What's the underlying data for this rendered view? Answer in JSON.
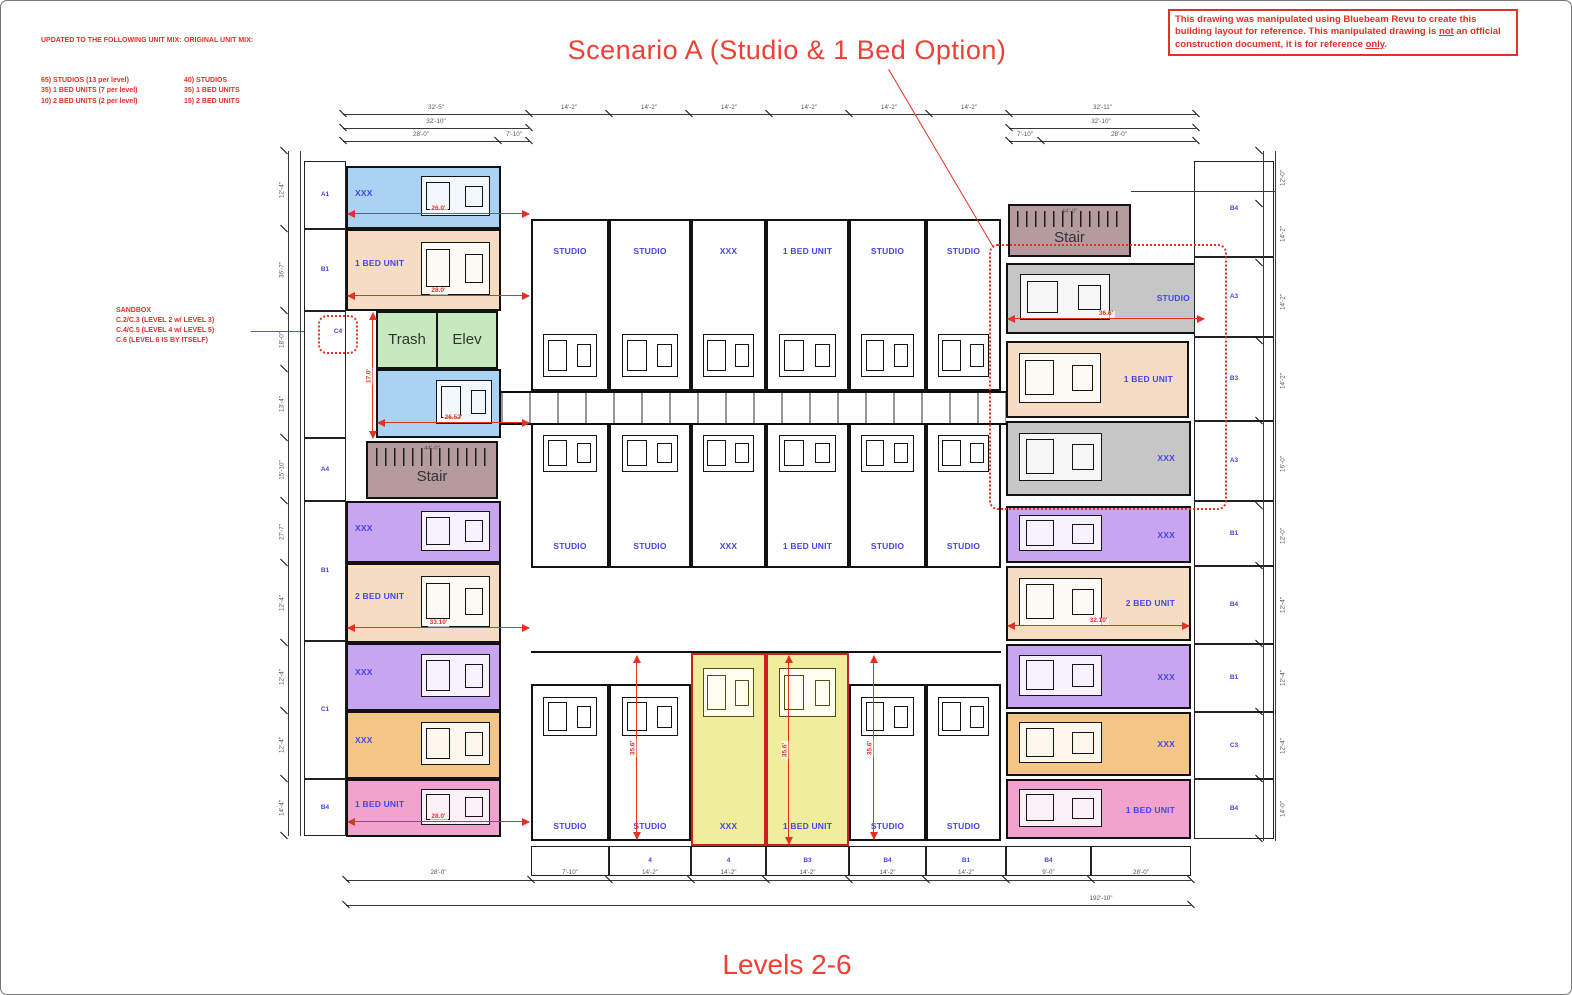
{
  "annotations": {
    "title": "Scenario A (Studio & 1 Bed Option)",
    "subtitle": "Levels 2-6",
    "updated_mix": {
      "title": "UPDATED TO THE FOLLOWING UNIT MIX:",
      "lines": [
        "65) STUDIOS (13 per level)",
        "35) 1 BED UNITS (7 per level)",
        "10) 2 BED UNITS (2 per level)"
      ]
    },
    "original_mix": {
      "title": "ORIGINAL UNIT MIX:",
      "lines": [
        "40) STUDIOS",
        "35) 1 BED UNITS",
        "15) 2 BED UNITS"
      ]
    },
    "disclaimer": {
      "p1": "This drawing was manipulated using Bluebeam Revu to create this building layout for reference. This manipulated drawing is ",
      "u1": "not",
      "p2": " an official construction document, it is for reference ",
      "u2": "only",
      "p3": "."
    },
    "sandbox_note": [
      "SANDBOX",
      "C.2/C.3 (LEVEL 2 w/ LEVEL 3)",
      "C.4/C.5 (LEVEL 4 w/ LEVEL 5)",
      "C.6 (LEVEL 6 IS BY ITSELF)"
    ]
  },
  "colors": {
    "annotation_red": "#e23127",
    "label_blue": "#4545ee",
    "dim_gray": "#555555",
    "wall_black": "#121212",
    "units": {
      "blue": "#a9d2f3",
      "peach": "#f6dcc3",
      "green": "#c8e9bf",
      "stair": "#b59b9d",
      "purple": "#c8a5f1",
      "orange": "#f3c688",
      "pink": "#f2a3cd",
      "gray": "#c6c6c7",
      "yellow": "#f0ee9d",
      "white": "#ffffff",
      "yellow_border": "#c92121"
    }
  },
  "plan": {
    "left_wing": [
      {
        "label": "XXX",
        "color": "blue",
        "dim": "26.0'"
      },
      {
        "label": "1 BED UNIT",
        "color": "peach",
        "dim": "28.0'"
      },
      {
        "label": "Trash",
        "label2": "Elev",
        "color": "green"
      },
      {
        "label": "",
        "color": "blue",
        "dim": "26.52'"
      },
      {
        "label": "Stair",
        "color": "stair",
        "room_dim": "44'-0\""
      },
      {
        "label": "XXX",
        "color": "purple"
      },
      {
        "label": "2 BED UNIT",
        "color": "peach",
        "dim": "33.10'"
      },
      {
        "label": "XXX",
        "color": "purple"
      },
      {
        "label": "XXX",
        "color": "orange"
      },
      {
        "label": "1 BED UNIT",
        "color": "pink",
        "dim": "28.0'"
      }
    ],
    "right_wing": [
      {
        "label": "Stair",
        "color": "stair",
        "room_dim": "44'-0\""
      },
      {
        "label": "STUDIO",
        "color": "gray",
        "dim": "36.6'"
      },
      {
        "label": "1 BED UNIT",
        "color": "peach"
      },
      {
        "label": "XXX",
        "color": "gray"
      },
      {
        "label": "XXX",
        "color": "purple"
      },
      {
        "label": "2 BED UNIT",
        "color": "peach",
        "dim": "32.10'"
      },
      {
        "label": "XXX",
        "color": "purple"
      },
      {
        "label": "XXX",
        "color": "orange"
      },
      {
        "label": "1 BED UNIT",
        "color": "pink"
      }
    ],
    "bands": {
      "top": [
        "STUDIO",
        "STUDIO",
        "XXX",
        "1 BED UNIT",
        "STUDIO",
        "STUDIO"
      ],
      "middle": [
        "STUDIO",
        "STUDIO",
        "XXX",
        "1 BED UNIT",
        "STUDIO",
        "STUDIO"
      ],
      "bottom": [
        {
          "label": "STUDIO"
        },
        {
          "label": "STUDIO"
        },
        {
          "label": "XXX",
          "highlight": true
        },
        {
          "label": "1 BED UNIT",
          "highlight": true
        },
        {
          "label": "STUDIO"
        },
        {
          "label": "STUDIO"
        }
      ]
    },
    "grid_codes": {
      "left": [
        "A1",
        "B1",
        "",
        "A4",
        "B1",
        "C1",
        "B4"
      ],
      "left_cloud_code": "C4",
      "right": [
        "B4",
        "A3",
        "B3",
        "A3",
        "B1",
        "B4",
        "B1",
        "C3",
        "B4"
      ],
      "bottom": [
        "4",
        "4",
        "B3",
        "B4",
        "B1",
        "B4"
      ]
    },
    "dims": {
      "top_main": [
        "32'-5\"",
        "14'-2\"",
        "14'-2\"",
        "14'-2\"",
        "14'-2\"",
        "14'-2\"",
        "14'-2\"",
        "32'-11\""
      ],
      "top_sub_left_mid": "32'-10\"",
      "top_sub_left_a": "28'-0\"",
      "top_sub_left_b": "7'-10\"",
      "top_sub_right_mid": "32'-10\"",
      "top_sub_right_a": "7'-10\"",
      "top_sub_right_b": "28'-0\"",
      "bottom_row": [
        "28'-0\"",
        "7'-10\"",
        "14'-2\"",
        "14'-2\"",
        "14'-2\"",
        "14'-2\"",
        "14'-2\"",
        "9'-0\"",
        "28'-0\""
      ],
      "bottom_overall": "192'-10\"",
      "left_col": [
        "12'-4\"",
        "36'-7\"",
        "18'-0\"",
        "13'-4\"",
        "15'-10\"",
        "27'-7\"",
        "12'-4\"",
        "12'-4\"",
        "12'-4\"",
        "14'-4\""
      ],
      "right_col": [
        "12'-0\"",
        "14'-2\"",
        "14'-2\"",
        "14'-2\"",
        "16'-0\"",
        "12'-0\"",
        "12'-4\"",
        "12'-4\"",
        "12'-4\"",
        "14'-0\""
      ],
      "yellow_vertical": "35.6'",
      "left_wing_vertical": "17.0'"
    }
  }
}
